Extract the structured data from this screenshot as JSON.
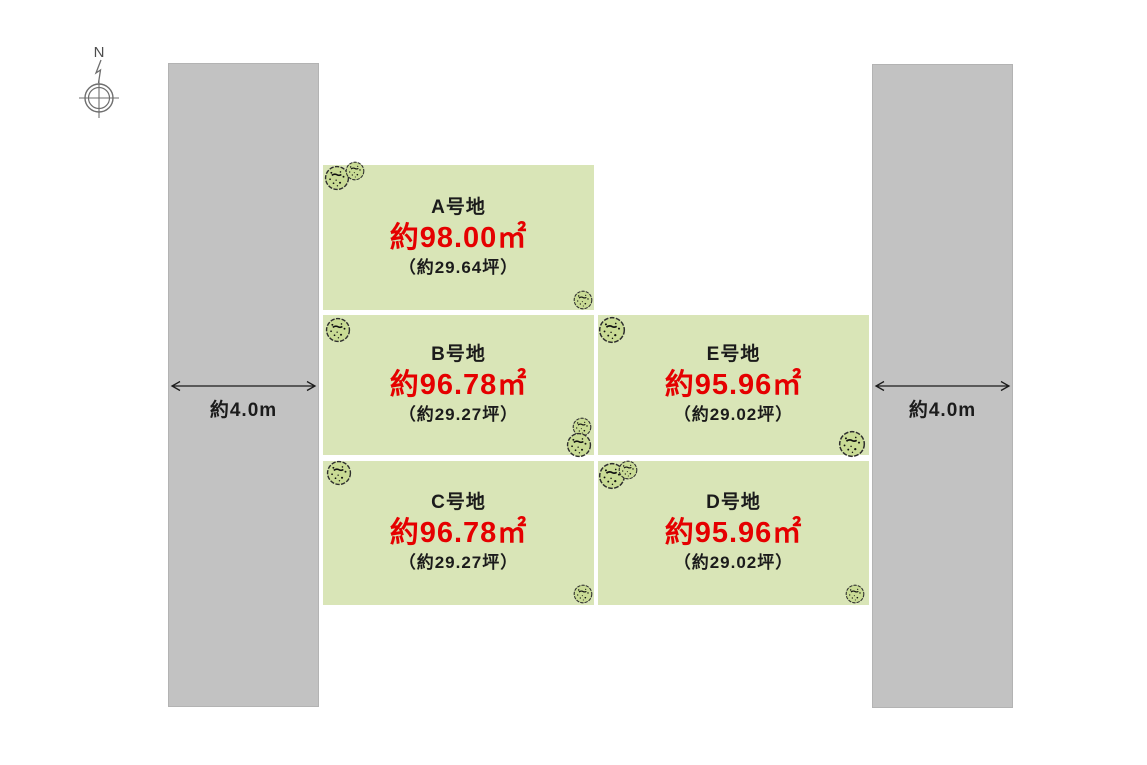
{
  "diagram_title": "宅地分譲区画図",
  "compass": {
    "label": "N"
  },
  "roads": {
    "left": {
      "width_label": "約4.0m"
    },
    "right": {
      "width_label": "約4.0m"
    }
  },
  "plots": {
    "a": {
      "name": "A号地",
      "area": "約98.00㎡",
      "tsubo": "（約29.64坪）"
    },
    "b": {
      "name": "B号地",
      "area": "約96.78㎡",
      "tsubo": "（約29.27坪）"
    },
    "e": {
      "name": "E号地",
      "area": "約95.96㎡",
      "tsubo": "（約29.02坪）"
    },
    "c": {
      "name": "C号地",
      "area": "約96.78㎡",
      "tsubo": "（約29.27坪）"
    },
    "d": {
      "name": "D号地",
      "area": "約95.96㎡",
      "tsubo": "（約29.02坪）"
    }
  },
  "icons": {
    "compass": "north-compass-icon",
    "tree": "tree-icon",
    "arrow": "double-headed-arrow-icon"
  },
  "colors": {
    "plot_fill": "#d9e5b7",
    "road_fill": "#c2c2c2",
    "area_text": "#e50000",
    "body_text": "#1b1b1b",
    "tree_fill": "#c9db95",
    "compass_stroke": "#6e6e6e",
    "background": "#ffffff"
  }
}
